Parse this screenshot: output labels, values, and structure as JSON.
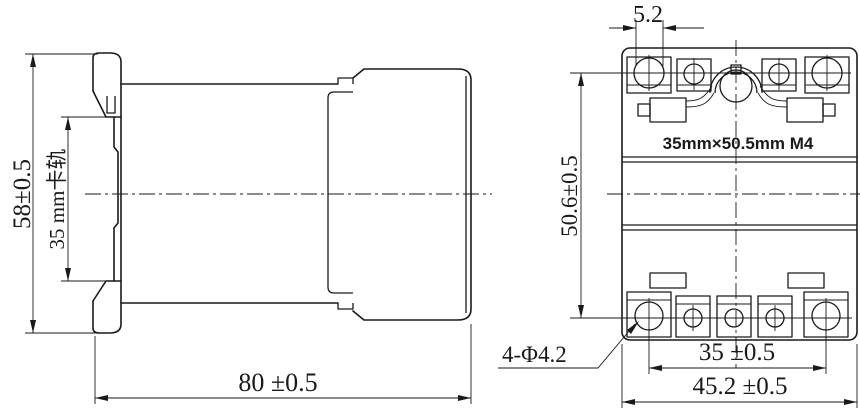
{
  "page": {
    "background": "#ffffff",
    "line_color": "#1a1a1a"
  },
  "side_view": {
    "dim_height": "58±0.5",
    "dim_rail": "35 mm卡轨",
    "dim_depth": "80 ±0.5"
  },
  "front_view": {
    "dim_terminal": "5.2",
    "dim_vertical_pitch": "50.6±0.5",
    "mount_label": "35mm×50.5mm M4",
    "dim_holes": "4-Φ4.2",
    "dim_hole_pitch": "35 ±0.5",
    "dim_width": "45.2 ±0.5"
  }
}
